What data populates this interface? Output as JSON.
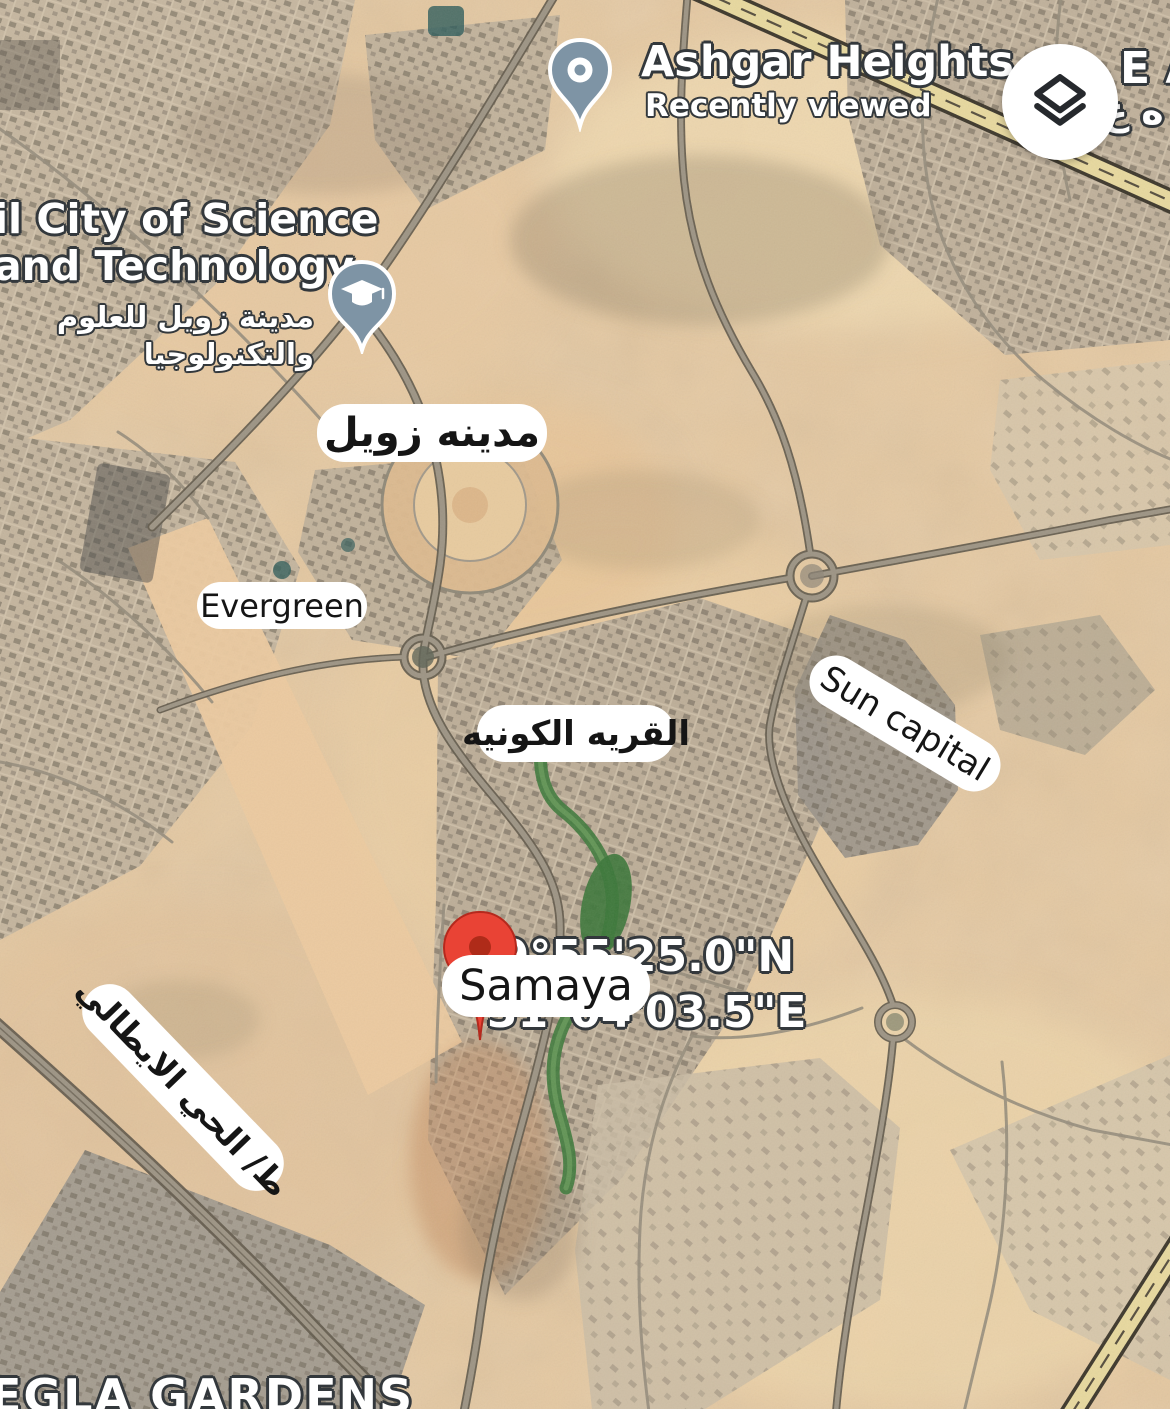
{
  "pois": {
    "ashgar_heights": {
      "title": "Ashgar Heights",
      "subtitle": "Recently viewed",
      "icon": "map-pin-icon"
    },
    "science_city": {
      "title_line1": "il City of Science",
      "title_line2": "and Technology",
      "subtitle_ar_line1": "مدينة زويل للعلوم",
      "subtitle_ar_line2": "والتكنولوجيا",
      "icon": "graduation-cap-icon"
    }
  },
  "annotations": {
    "zewail_city": "مدينه زويل",
    "evergreen": "Evergreen",
    "cosmic_village": "القريه الكونيه",
    "sun_capital": "Sun capital",
    "samaya": "Samaya",
    "italian_district_road": "ط/ الحي الايطالي"
  },
  "dropped_pin": {
    "icon": "red-pin-icon",
    "coord_line1": "29°55'25.0\"N",
    "coord_line2": "31°04'03.5\"E"
  },
  "edge_labels": {
    "top_right": "E A",
    "top_right_arabic": "ه ع",
    "bottom_left": "EGLA GARDENS"
  },
  "controls": {
    "layers_button_icon": "layers-icon"
  },
  "colors": {
    "desert_base": "#e6c9a1",
    "urban_block": "#c3b49d",
    "road": "#9d9484",
    "road_casing": "#655d4e",
    "highway_fill": "#e7d89e",
    "highway_casing": "#3e382c",
    "green_area": "#3f7a3c",
    "poi_icon_blue": "#7e94a5",
    "pin_red": "#e94335",
    "annotation_bg": "#ffffff",
    "annotation_text": "#151515",
    "label_white": "#ffffff",
    "label_outline": "#33383c"
  }
}
